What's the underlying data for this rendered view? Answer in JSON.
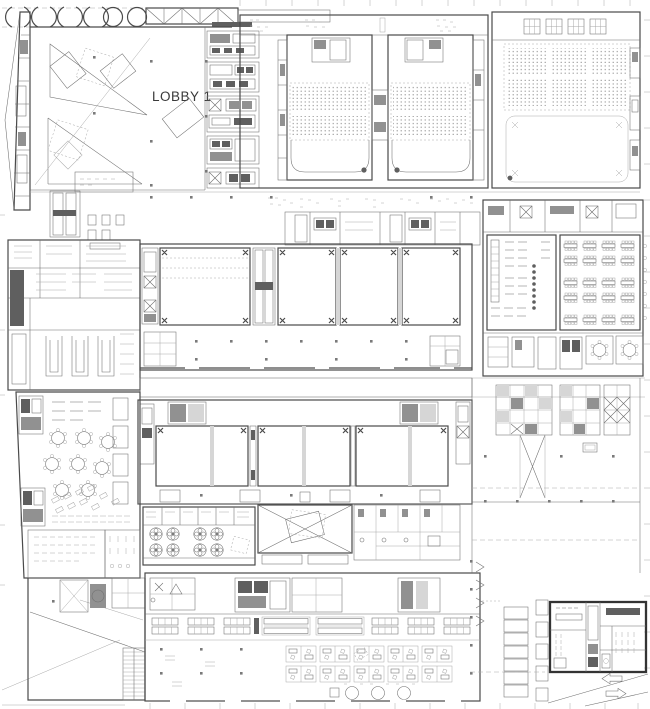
{
  "labels": {
    "lobby": "LOBBY 1"
  },
  "colors": {
    "background": "#ffffff",
    "line": "#6e6e6e",
    "wall": "#4a4a4a",
    "bold_outline": "#333333",
    "dark_fill": "#5f5f5f",
    "mid_fill": "#919191",
    "light_fill": "#d6d6d6",
    "seat_dot": "#8f8f8f"
  },
  "icons": [
    "column-circle-icon",
    "column-arc-icon",
    "roof-truss-icon",
    "stair-hatch-icon",
    "escalator-icon",
    "elevator-x-icon",
    "fan-icon",
    "round-table-icon",
    "seat-dot-grid-icon",
    "direction-arrow-left-icon",
    "direction-arrow-right-icon"
  ],
  "areas": [
    "west-wing",
    "lobby",
    "elevator-core-band",
    "theater-1",
    "theater-2",
    "grand-hall",
    "mezzanine-band",
    "kitchen-block",
    "upper-meeting-halls",
    "banquet-rooms",
    "link-corridor",
    "lower-meeting-halls",
    "plant-rooms",
    "restaurant",
    "seminar-rooms",
    "back-of-house",
    "office-floor",
    "tower-cores",
    "service-yard",
    "annex-block"
  ]
}
